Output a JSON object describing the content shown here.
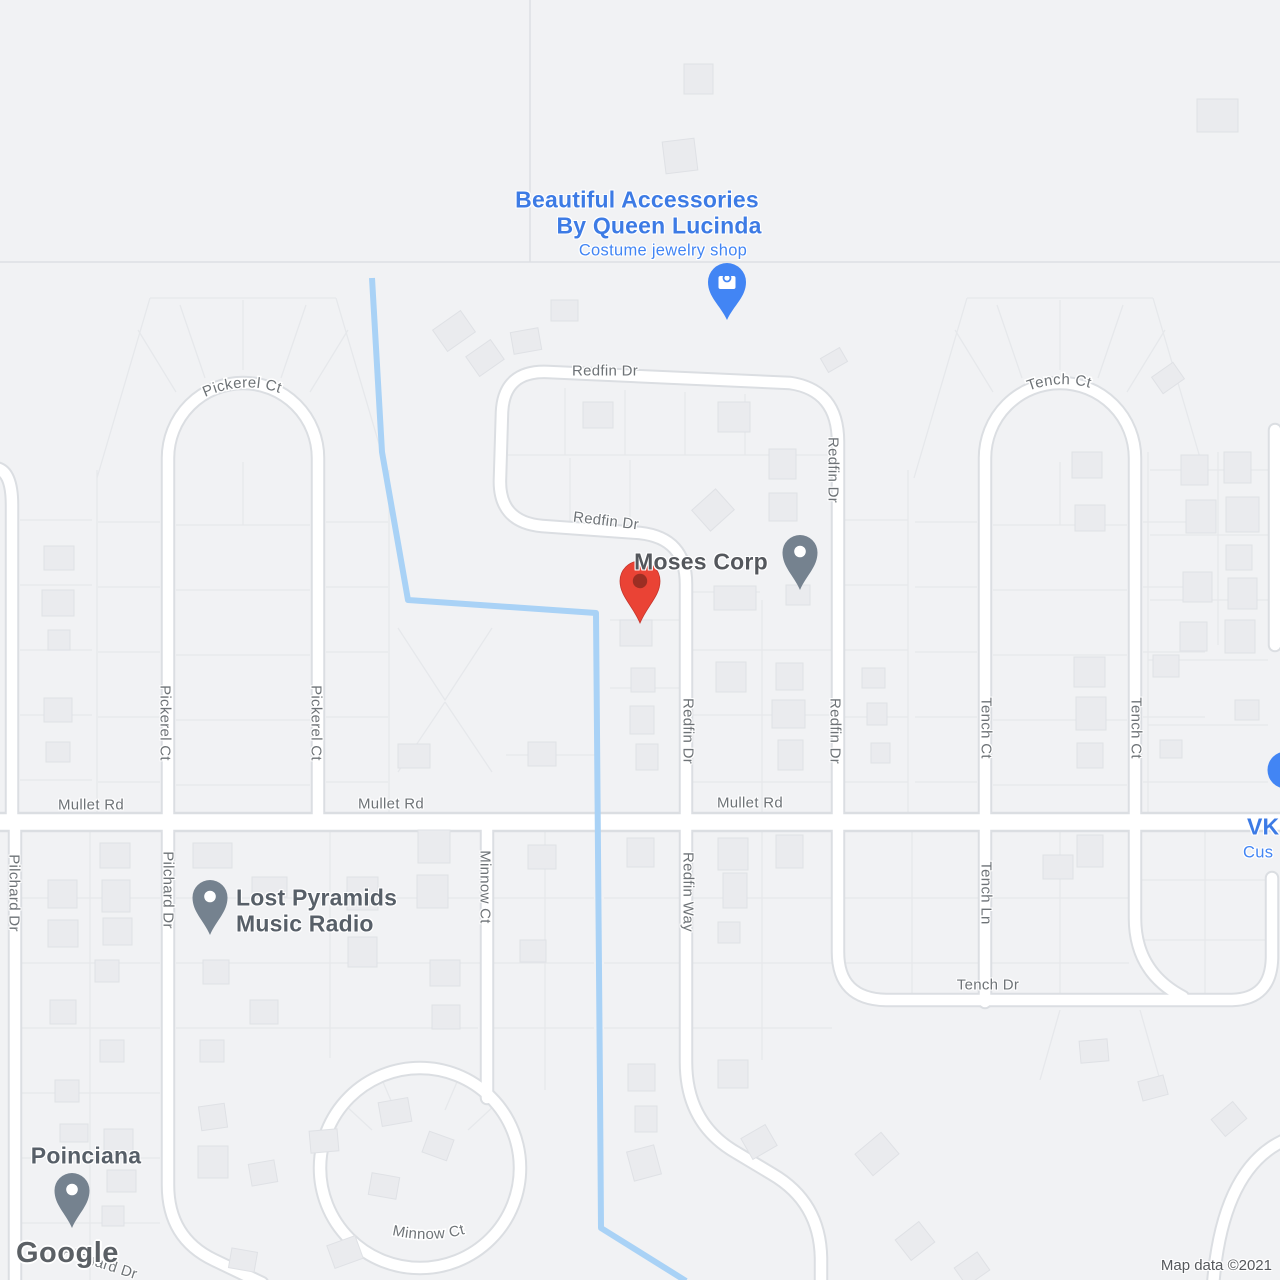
{
  "map": {
    "logo": "Google",
    "attribution": "Map data ©2021"
  },
  "streets": {
    "redfin_dr": "Redfin Dr",
    "redfin_way": "Redfin Way",
    "mullet_rd": "Mullet Rd",
    "pickerel_ct": "Pickerel Ct",
    "pilchard_dr": "Pilchard Dr",
    "minnow_ct": "Minnow Ct",
    "tench_ct": "Tench Ct",
    "tench_ln": "Tench Ln",
    "tench_dr": "Tench Dr"
  },
  "places": {
    "jewelry_shop": {
      "name_line1": "Beautiful Accessories",
      "name_line2": "By Queen Lucinda",
      "category": "Costume jewelry shop",
      "icon": "shopping-bag-pin"
    },
    "moses_corp": {
      "name": "Moses Corp",
      "icon": "gray-poi-pin"
    },
    "lost_pyramids": {
      "name_line1": "Lost Pyramids",
      "name_line2": "Music Radio",
      "icon": "gray-poi-pin"
    },
    "poinciana": {
      "name": "Poinciana",
      "icon": "gray-poi-pin"
    },
    "vk_partial": {
      "name": "VK",
      "category": "Cus",
      "icon": "blue-poi-pin"
    }
  },
  "colors": {
    "marker_red": "#EA4335",
    "marker_red_inner": "#8E2A20",
    "poi_pin_gray": "#75828F",
    "business_blue": "#3D7BE5",
    "category_blue": "#4285F4",
    "water_blue": "#A9D2F6",
    "street_label_gray": "#6E7377"
  }
}
